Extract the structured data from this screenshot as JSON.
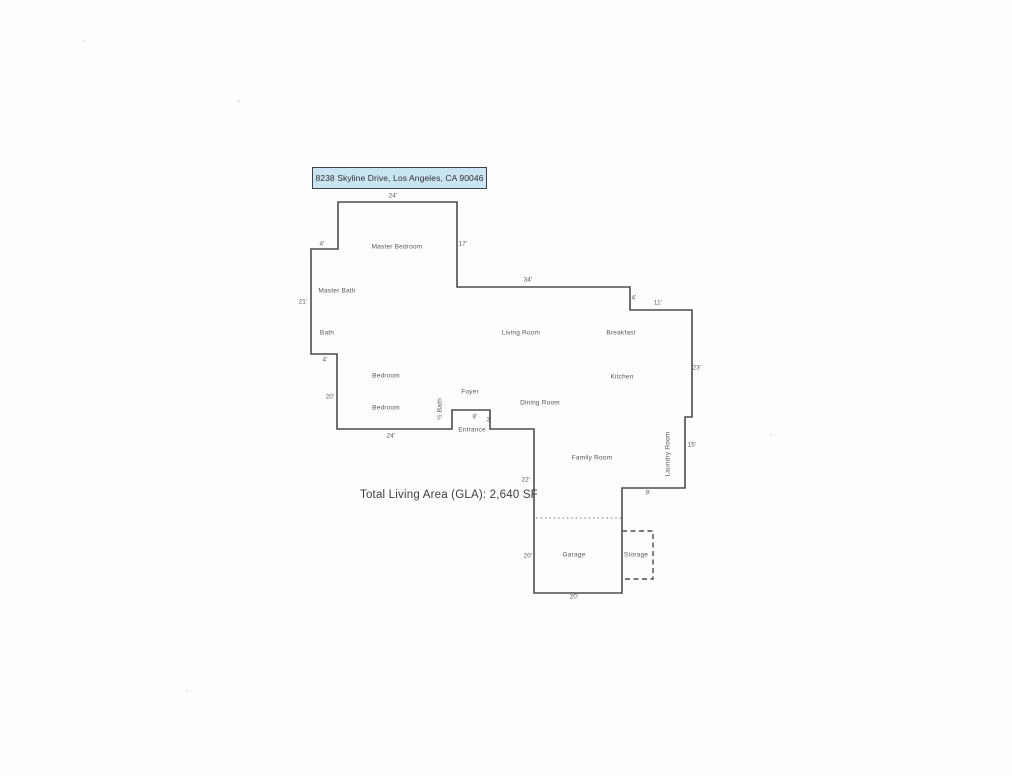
{
  "document": {
    "address": "8238 Skyline Drive, Los Angeles, CA 90046",
    "total_living_area": "Total Living Area (GLA): 2,640 SF"
  },
  "rooms": {
    "master_bedroom": "Master Bedroom",
    "master_bath": "Master Bath",
    "bath": "Bath",
    "living_room": "Living Room",
    "breakfast": "Breakfast",
    "kitchen": "Kitchen",
    "bedroom_upper": "Bedroom",
    "bedroom_lower": "Bedroom",
    "foyer": "Foyer",
    "dining_room": "Dining Room",
    "half_bath": "½ Bath",
    "entrance": "Entrance",
    "family_room": "Family Room",
    "laundry_room": "Laundry Room",
    "garage": "Garage",
    "storage": "Storage"
  },
  "dimensions": {
    "master_bedroom_width": "24'",
    "master_bedroom_left_offset": "4'",
    "master_bedroom_right_height": "17'",
    "living_room_top_width": "34'",
    "breakfast_step_height": "4'",
    "breakfast_top_width": "11'",
    "west_wall_height": "21'",
    "east_wall_height": "23'",
    "bath_bottom_offset": "4'",
    "bedroom_wall_height": "20'",
    "bedroom_bottom_width": "24'",
    "entrance_width": "8'",
    "entrance_depth": "3'",
    "family_room_wall_height": "22'",
    "laundry_wall_height": "15'",
    "family_room_bottom_width": "9'",
    "garage_wall_height": "20'",
    "garage_bottom_width": "20'"
  },
  "colors": {
    "address_box_bg": "#c9e4f2",
    "address_box_border": "#414141",
    "wall_line": "#4d4d4d",
    "dotted_divider": "#999999",
    "label_text": "#575757"
  }
}
